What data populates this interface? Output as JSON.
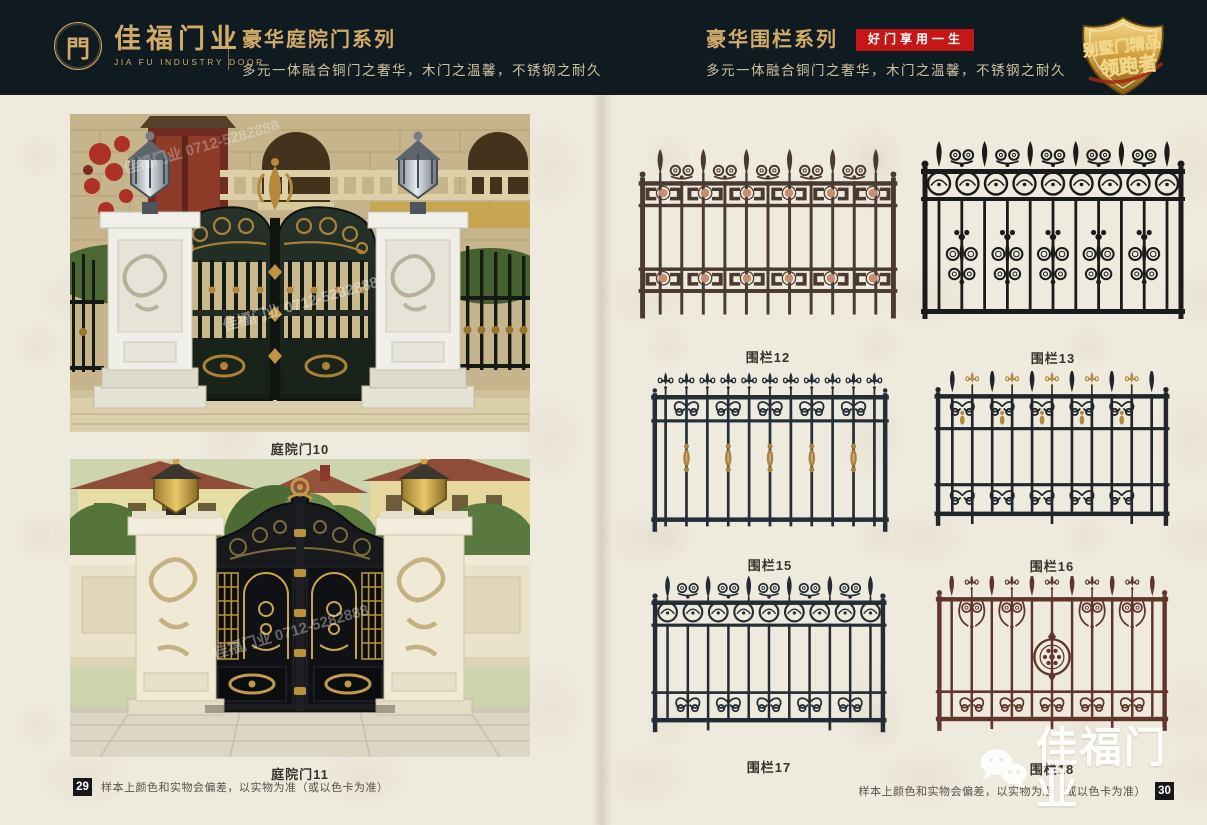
{
  "colors": {
    "header_bg": "#0f1b21",
    "gold": "#d3ab69",
    "gold_dim": "#cfc2a0",
    "red_badge_bg": "#c51717",
    "red_badge_text": "#ffffff",
    "page_bg": "#efeade",
    "caption": "#35332d",
    "note": "#56514a",
    "pagenum_bg": "#171717"
  },
  "header": {
    "logo": {
      "symbol": "門",
      "name": "佳福门业",
      "name_en": "JIA FU INDUSTRY DOOR"
    },
    "left_section": {
      "title": "豪华庭院门系列",
      "subtitle": "多元一体融合铜门之奢华，木门之温馨，不锈钢之耐久"
    },
    "right_section": {
      "title": "豪华围栏系列",
      "badge": "好门享用一生",
      "subtitle": "多元一体融合铜门之奢华，木门之温馨，不锈钢之耐久"
    },
    "shield_badge": {
      "line1": "别墅门精品",
      "line2": "领跑者"
    }
  },
  "left_page": {
    "products": [
      {
        "label": "庭院门10"
      },
      {
        "label": "庭院门11"
      }
    ],
    "photo_watermark": "佳福门业 0712-5282888",
    "footer": {
      "page_number": "29",
      "note": "样本上颜色和实物会偏差，以实物为准（或以色卡为准）"
    }
  },
  "right_page": {
    "fences": [
      {
        "label": "围栏12",
        "color": "#4a3a31",
        "accent": "#c68d72",
        "style": "key-bands"
      },
      {
        "label": "围栏13",
        "color": "#1b1b1b",
        "accent": "#1b1b1b",
        "style": "circle-fleur"
      },
      {
        "label": "围栏15",
        "color": "#232e38",
        "accent": "#a8813f",
        "style": "fleur-collars"
      },
      {
        "label": "围栏16",
        "color": "#20262c",
        "accent": "#b08a3c",
        "style": "alt-scrolls"
      },
      {
        "label": "围栏17",
        "color": "#242d35",
        "accent": "#8a8a74",
        "style": "circle-hearts"
      },
      {
        "label": "围栏18",
        "color": "#5f352c",
        "accent": "#5f352c",
        "style": "medallion"
      }
    ],
    "footer": {
      "note": "样本上颜色和实物会偏差，以实物为准（或以色卡为准）",
      "page_number": "30"
    },
    "watermark": {
      "brand": "佳福门业",
      "icon": "wechat"
    }
  }
}
